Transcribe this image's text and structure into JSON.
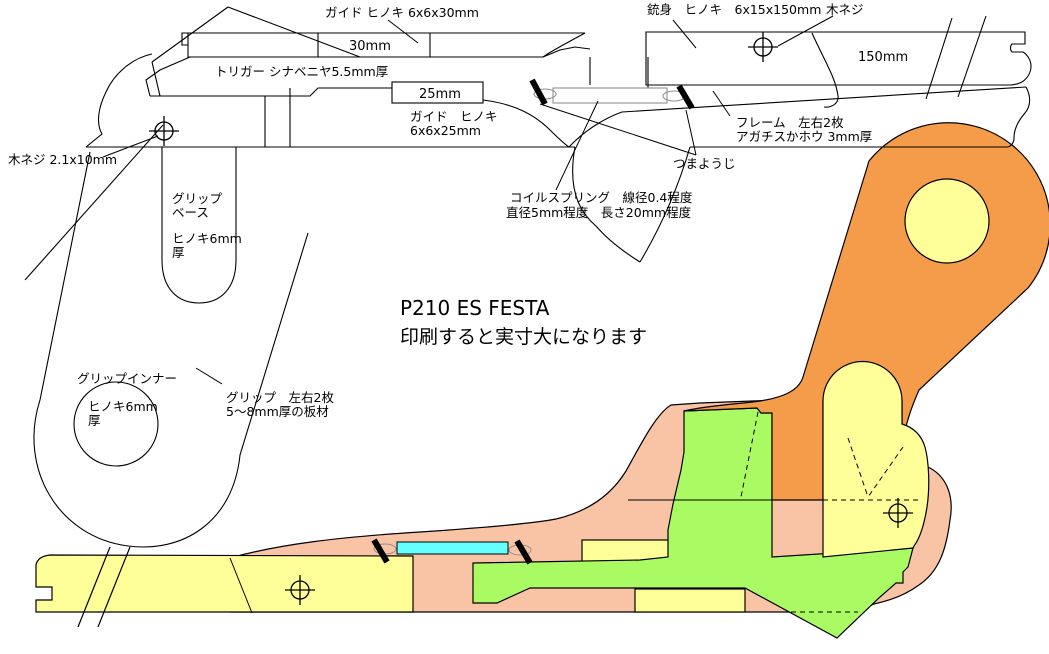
{
  "title": {
    "model": "P210 ES FESTA",
    "note": "印刷すると実寸大になります"
  },
  "labels": {
    "guide_front": "ガイド ヒノキ 6x6x30mm",
    "guide_front_len": "30mm",
    "trigger": "トリガー シナベニヤ5.5mm厚",
    "guide_rear_len": "25mm",
    "guide_rear_line1": "ガイド　ヒノキ",
    "guide_rear_line2": "6x6x25mm",
    "barrel": "銃身　ヒノキ　6x15x150mm",
    "wood_screw": "木ネジ",
    "barrel_len": "150mm",
    "frame_line1": "フレーム　左右2枚",
    "frame_line2": "アガチスかホウ 3mm厚",
    "toothpick": "つまようじ",
    "wood_screw_size": "木ネジ 2.1x10mm",
    "grip_base_line1": "グリップ",
    "grip_base_line2": "ベース",
    "grip_base_line3": "ヒノキ6mm",
    "grip_base_line4": "厚",
    "spring_line1": "コイルスプリング　線径0.4程度",
    "spring_line2": "直径5mm程度　長さ20mm程度",
    "grip_inner_line1": "グリップインナー",
    "grip_inner_line2": "ヒノキ6mm",
    "grip_inner_line3": "厚",
    "grip_line1": "グリップ　左右2枚",
    "grip_line2": "5～8mm厚の板材"
  },
  "colors": {
    "frame_salmon": "#F9C3A5",
    "wood_yellow": "#FFFF99",
    "grip_orange": "#F49C4A",
    "trigger_green": "#AAFA64",
    "spring_cyan": "#66FFFF",
    "outline": "#000000",
    "spring_gray": "#909090"
  }
}
